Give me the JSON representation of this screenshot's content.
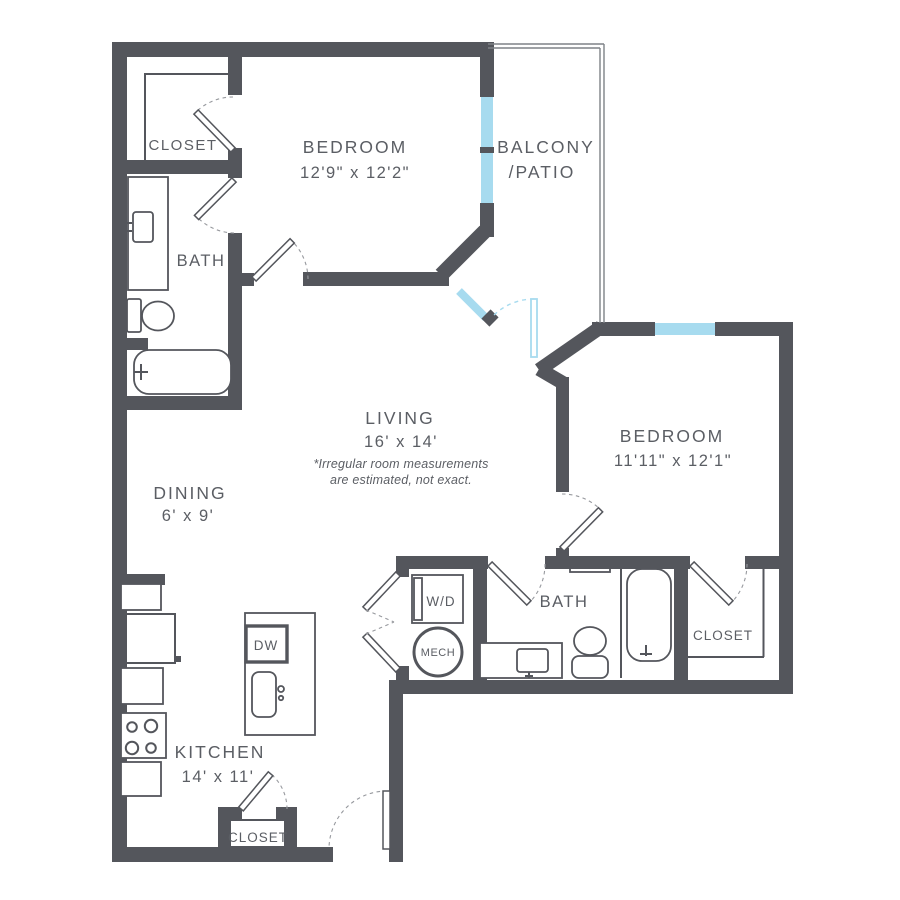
{
  "rooms": {
    "bedroom1": {
      "name": "BEDROOM",
      "dims": "12'9\" x 12'2\""
    },
    "balcony": {
      "name": "BALCONY",
      "name2": "/PATIO"
    },
    "closet1": {
      "name": "CLOSET"
    },
    "bath1": {
      "name": "BATH"
    },
    "living": {
      "name": "LIVING",
      "dims": "16' x 14'",
      "note1": "*Irregular room measurements",
      "note2": "are estimated, not exact."
    },
    "dining": {
      "name": "DINING",
      "dims": "6' x 9'"
    },
    "bedroom2": {
      "name": "BEDROOM",
      "dims": "11'11\" x 12'1\""
    },
    "bath2": {
      "name": "BATH"
    },
    "closet2": {
      "name": "CLOSET"
    },
    "kitchen": {
      "name": "KITCHEN",
      "dims": "14' x 11'"
    },
    "kitchen_closet": {
      "name": "CLOSET"
    },
    "laundry": {
      "name": "W/D"
    },
    "mech": {
      "name": "MECH"
    },
    "dishwasher": {
      "name": "DW"
    }
  },
  "colors": {
    "wall": "#54565c",
    "window": "#a7dbef",
    "fixture": "#54565c",
    "swing_arc": "#97999e",
    "text": "#5b5e64"
  }
}
